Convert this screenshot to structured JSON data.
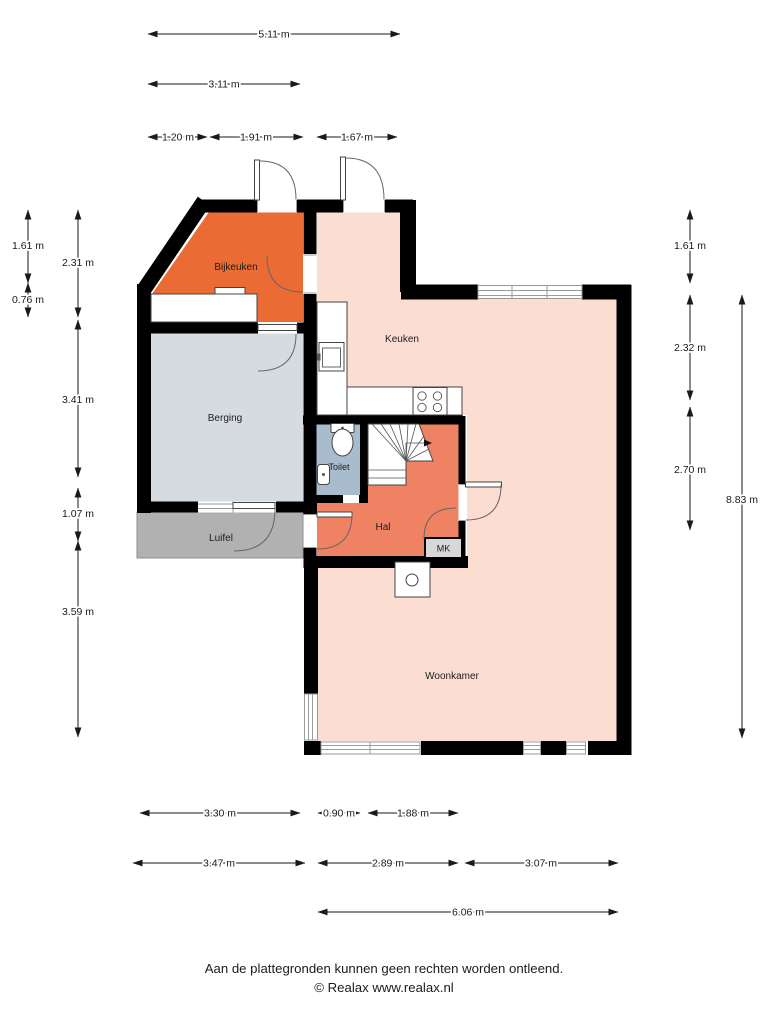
{
  "plan": {
    "rooms": {
      "bijkeuken": {
        "label": "Bijkeuken",
        "color": "#ea6b33"
      },
      "berging": {
        "label": "Berging",
        "color": "#d5dbe1"
      },
      "luifel": {
        "label": "Luifel",
        "color": "#b1b1b1"
      },
      "keuken": {
        "label": "Keuken",
        "color": "#fbddd1"
      },
      "toilet": {
        "label": "Toilet",
        "color": "#a9bcce"
      },
      "hal": {
        "label": "Hal",
        "color": "#ee8262"
      },
      "mk": {
        "label": "MK",
        "color": "#d8d8d8"
      },
      "woonkamer": {
        "label": "Woonkamer",
        "color": "#fbddd1"
      }
    },
    "wall_color": "#000000",
    "dimensions": {
      "top": [
        "5.11 m",
        "3.11 m",
        "1.20 m",
        "1.91 m",
        "1.67 m"
      ],
      "left": [
        "1.61 m",
        "0.76 m",
        "2.31 m",
        "3.41 m",
        "1.07 m",
        "3.59 m"
      ],
      "right": [
        "1.61 m",
        "2.32 m",
        "2.70 m",
        "8.83 m"
      ],
      "bottom": [
        "3.30 m",
        "0.90 m",
        "1.88 m",
        "3.47 m",
        "2.89 m",
        "3.07 m",
        "6.06 m"
      ]
    }
  },
  "footer": {
    "line1": "Aan de plattegronden kunnen geen rechten worden ontleend.",
    "line2": "© Realax www.realax.nl"
  }
}
